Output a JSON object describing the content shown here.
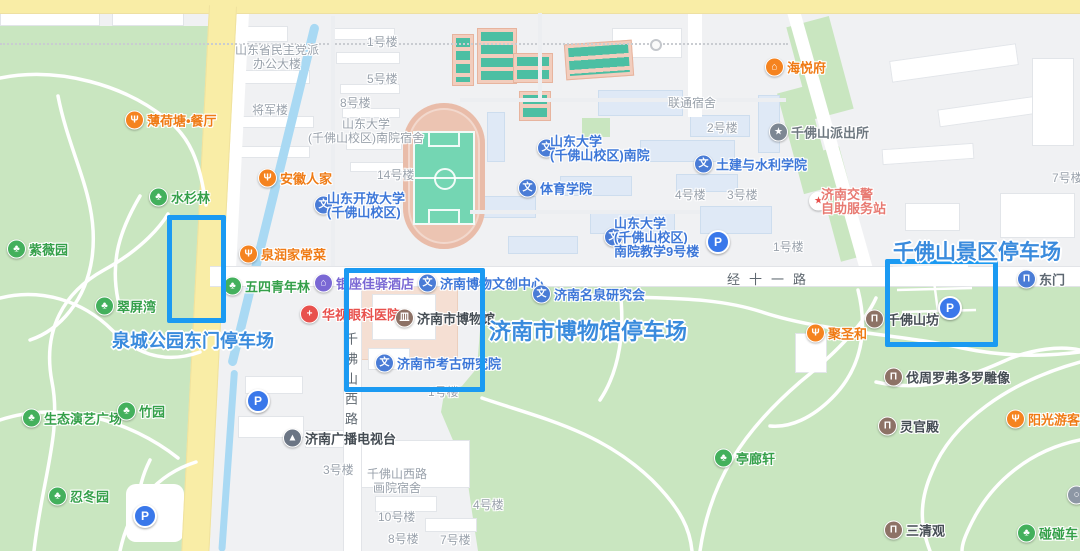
{
  "annotations": {
    "box_color": "#1b9af2",
    "text_color": "#3a8bdd",
    "boxes": [
      {
        "name": "quancheng-park-east-gate-parking-box",
        "x": 167,
        "y": 215,
        "w": 49,
        "h": 98
      },
      {
        "name": "jinan-museum-parking-box",
        "x": 344,
        "y": 268,
        "w": 131,
        "h": 114
      },
      {
        "name": "qianfoshan-scenic-parking-box",
        "x": 885,
        "y": 259,
        "w": 103,
        "h": 78
      }
    ],
    "labels": [
      {
        "text": "泉城公园东门停车场",
        "x": 112,
        "y": 327,
        "size": 18
      },
      {
        "text": "济南市博物馆停车场",
        "x": 489,
        "y": 314,
        "size": 22
      },
      {
        "text": "千佛山景区停车场",
        "x": 893,
        "y": 236,
        "size": 21
      }
    ]
  },
  "roads": {
    "labels": [
      {
        "text": "经十一路",
        "x": 727,
        "y": 269,
        "vertical": false
      },
      {
        "text": "千佛山西路",
        "x": 341,
        "y": 332,
        "vertical": true
      }
    ]
  },
  "icon_styles": {
    "tree": {
      "bg": "#43b05c",
      "text": "#35a04a",
      "glyph": "♣"
    },
    "bumper-car": {
      "bg": "#43b05c",
      "text": "#35a04a",
      "glyph": "♣"
    },
    "restaurant": {
      "bg": "#f5831f",
      "text": "#ef7b15",
      "glyph": "Ψ"
    },
    "house": {
      "bg": "#f5831f",
      "text": "#ef7b15",
      "glyph": "⌂"
    },
    "school": {
      "bg": "#4a7cd6",
      "text": "#3d77d8",
      "glyph": "文"
    },
    "institution": {
      "bg": "#4a7cd6",
      "text": "#3d77d8",
      "glyph": "文"
    },
    "gate": {
      "bg": "#4a7cd6",
      "text": "#5d6771",
      "glyph": "Π"
    },
    "hotel": {
      "bg": "#7a68d4",
      "text": "#7a68d4",
      "glyph": "⌂"
    },
    "hospital": {
      "bg": "#e8514d",
      "text": "#e8514d",
      "glyph": "+"
    },
    "traffic-police": {
      "bg": "#ffffff",
      "text": "#e87a72",
      "glyph": "★",
      "glyph_color": "#e8514d"
    },
    "police": {
      "bg": "#7d8793",
      "text": "#6e7880",
      "glyph": "★"
    },
    "museum": {
      "bg": "#8d7266",
      "text": "#454d54",
      "glyph": "皿"
    },
    "archway": {
      "bg": "#8d7266",
      "text": "#454d54",
      "glyph": "Π"
    },
    "temple": {
      "bg": "#8d7266",
      "text": "#454d54",
      "glyph": "Π"
    },
    "statue": {
      "bg": "#8d7266",
      "text": "#454d54",
      "glyph": "Π"
    },
    "tv": {
      "bg": "#6b7584",
      "text": "#454d54",
      "glyph": "▲"
    },
    "generic": {
      "bg": "#8d97a5",
      "text": "#454d54",
      "glyph": "○"
    }
  },
  "pois": [
    {
      "label": "薄荷塘•餐厅",
      "type": "restaurant",
      "x": 125,
      "y": 120
    },
    {
      "label": "水杉林",
      "type": "tree",
      "x": 149,
      "y": 197
    },
    {
      "label": "紫薇园",
      "type": "tree",
      "x": 7,
      "y": 249
    },
    {
      "label": "翠屏湾",
      "type": "tree",
      "x": 95,
      "y": 306
    },
    {
      "label": "五四青年林",
      "type": "tree",
      "x": 223,
      "y": 286
    },
    {
      "label": "生态演艺广场",
      "type": "tree",
      "x": 22,
      "y": 418
    },
    {
      "label": "竹园",
      "type": "tree",
      "x": 117,
      "y": 411
    },
    {
      "label": "忍冬园",
      "type": "tree",
      "x": 48,
      "y": 496
    },
    {
      "label": "亭廊轩",
      "type": "tree",
      "x": 714,
      "y": 458
    },
    {
      "label": "碰碰车",
      "type": "bumper-car",
      "x": 1017,
      "y": 533
    },
    {
      "label": "安徽人家",
      "type": "restaurant",
      "x": 258,
      "y": 178
    },
    {
      "label": "泉润家常菜",
      "type": "restaurant",
      "x": 239,
      "y": 254
    },
    {
      "label": "海悦府",
      "type": "house",
      "x": 765,
      "y": 67
    },
    {
      "label": "聚圣和",
      "type": "restaurant",
      "x": 806,
      "y": 333
    },
    {
      "label": "阳光游客餐厅",
      "type": "restaurant",
      "x": 1006,
      "y": 419
    },
    {
      "lines": [
        "山东开放大学",
        "(千佛山校区)"
      ],
      "type": "school",
      "x": 314,
      "y": 205,
      "lx": 327,
      "ly": 192
    },
    {
      "lines": [
        "山东大学",
        "(千佛山校区)南院"
      ],
      "type": "school",
      "x": 537,
      "y": 148,
      "lx": 550,
      "ly": 135
    },
    {
      "label": "体育学院",
      "type": "school",
      "x": 518,
      "y": 188
    },
    {
      "label": "土建与水利学院",
      "type": "school",
      "x": 694,
      "y": 164
    },
    {
      "lines": [
        "山东大学",
        "(千佛山校区)",
        "南院教学9号楼"
      ],
      "type": "school",
      "x": 604,
      "y": 237,
      "lx": 614,
      "ly": 217
    },
    {
      "label": "济南博物文创中心",
      "type": "institution",
      "x": 418,
      "y": 283
    },
    {
      "label": "济南名泉研究会",
      "type": "institution",
      "x": 532,
      "y": 294
    },
    {
      "label": "济南市考古研究院",
      "type": "institution",
      "x": 375,
      "y": 363
    },
    {
      "label": "东门",
      "type": "gate",
      "x": 1017,
      "y": 279
    },
    {
      "label": "银座佳驿酒店",
      "type": "hotel",
      "x": 314,
      "y": 283
    },
    {
      "label": "华视眼科医院",
      "type": "hospital",
      "x": 300,
      "y": 314
    },
    {
      "lines": [
        "济南交警",
        "自助服务站"
      ],
      "type": "traffic-police",
      "x": 809,
      "y": 201,
      "lx": 821,
      "ly": 188
    },
    {
      "label": "千佛山派出所",
      "type": "police",
      "x": 769,
      "y": 132
    },
    {
      "label": "济南广播电视台",
      "type": "tv",
      "x": 283,
      "y": 438
    },
    {
      "label": "济南市博物馆",
      "type": "museum",
      "x": 395,
      "y": 318
    },
    {
      "label": "千佛山坊",
      "type": "archway",
      "x": 865,
      "y": 319
    },
    {
      "label": "伐周罗弗多罗雕像",
      "type": "statue",
      "x": 884,
      "y": 377
    },
    {
      "label": "灵官殿",
      "type": "temple",
      "x": 878,
      "y": 426
    },
    {
      "label": "三清观",
      "type": "temple",
      "x": 884,
      "y": 530
    },
    {
      "label": "",
      "type": "generic",
      "x": 1067,
      "y": 495
    }
  ],
  "parking_icons": [
    {
      "x": 718,
      "y": 242
    },
    {
      "x": 258,
      "y": 401
    },
    {
      "x": 145,
      "y": 516
    },
    {
      "x": 950,
      "y": 308
    }
  ],
  "building_labels": [
    {
      "lines": [
        "山东省民主党派",
        "办公大楼"
      ],
      "x": 277,
      "y": 57,
      "center": true
    },
    {
      "text": "将军楼",
      "x": 252,
      "y": 110
    },
    {
      "text": "1号楼",
      "x": 367,
      "y": 42
    },
    {
      "text": "5号楼",
      "x": 367,
      "y": 79
    },
    {
      "text": "8号楼",
      "x": 340,
      "y": 103
    },
    {
      "lines": [
        "山东大学",
        "(千佛山校区)南院宿舍"
      ],
      "x": 366,
      "y": 131,
      "center": true
    },
    {
      "text": "14号楼",
      "x": 377,
      "y": 175
    },
    {
      "text": "联通宿舍",
      "x": 668,
      "y": 103
    },
    {
      "text": "2号楼",
      "x": 707,
      "y": 128
    },
    {
      "text": "4号楼",
      "x": 675,
      "y": 195
    },
    {
      "text": "3号楼",
      "x": 727,
      "y": 195
    },
    {
      "text": "1号楼",
      "x": 773,
      "y": 247
    },
    {
      "text": "7号楼",
      "x": 1052,
      "y": 178
    },
    {
      "text": "1号楼",
      "x": 428,
      "y": 392
    },
    {
      "text": "3号楼",
      "x": 323,
      "y": 470
    },
    {
      "lines": [
        "千佛山西路",
        "画院宿舍"
      ],
      "x": 397,
      "y": 481,
      "center": true
    },
    {
      "text": "4号楼",
      "x": 473,
      "y": 505
    },
    {
      "text": "10号楼",
      "x": 378,
      "y": 517
    },
    {
      "text": "8号楼",
      "x": 388,
      "y": 539
    },
    {
      "text": "7号楼",
      "x": 440,
      "y": 540
    }
  ]
}
